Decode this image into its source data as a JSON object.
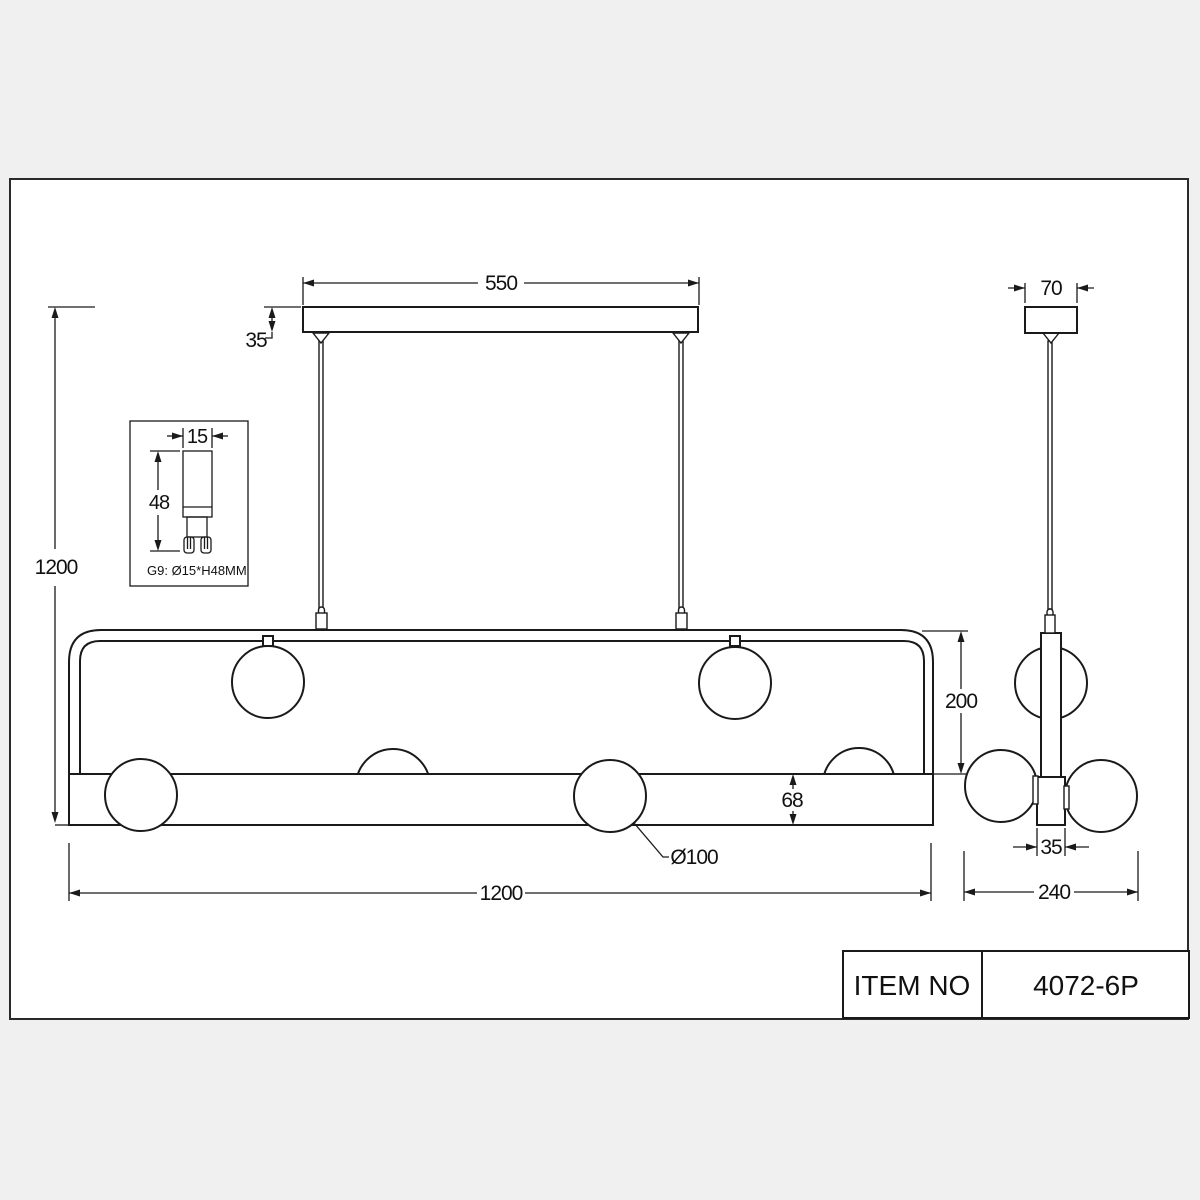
{
  "page": {
    "background": "#f0f0f0",
    "paper": "#ffffff",
    "line_color": "#1a1a1a"
  },
  "front_view": {
    "dims": {
      "canopy_width": "550",
      "canopy_height": "35",
      "total_height": "1200",
      "frame_height": "200",
      "bar_height": "68",
      "globe_diameter": "Ø100",
      "fixture_width": "1200"
    }
  },
  "side_view": {
    "dims": {
      "canopy_width": "70",
      "tube_width": "35",
      "overall_width": "240"
    }
  },
  "bulb_detail": {
    "dims": {
      "width": "15",
      "height": "48"
    },
    "label": "G9:  Ø15*H48MM"
  },
  "title_block": {
    "label": "ITEM NO",
    "value": "4072-6P"
  }
}
